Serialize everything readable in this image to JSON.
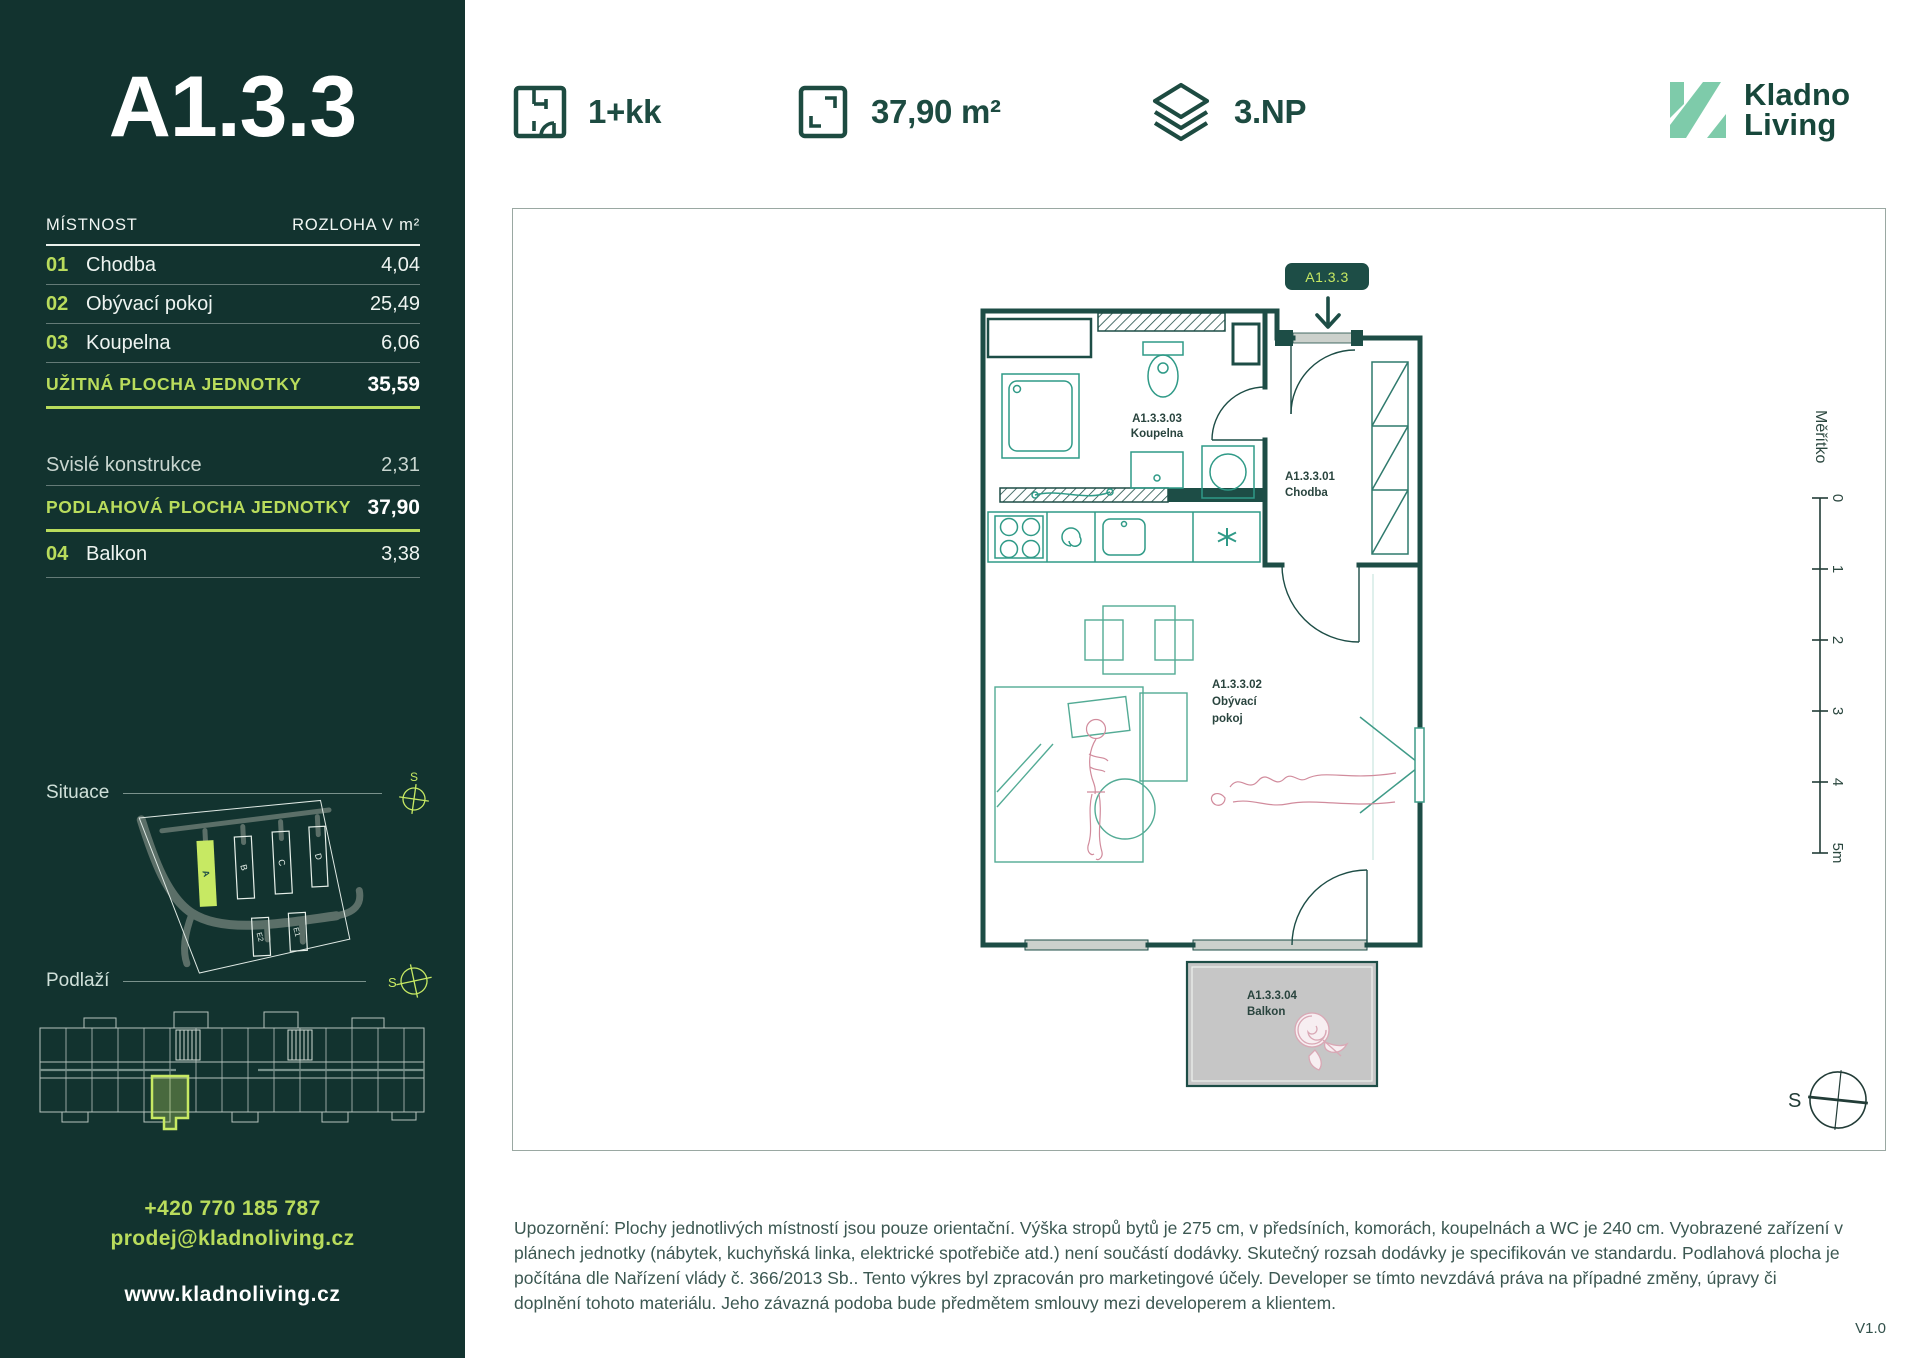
{
  "sidebar": {
    "unit_title": "A1.3.3",
    "table": {
      "header": {
        "room": "MÍSTNOST",
        "area": "ROZLOHA V m²"
      },
      "rows": [
        {
          "num": "01",
          "name": "Chodba",
          "value": "4,04"
        },
        {
          "num": "02",
          "name": "Obývací pokoj",
          "value": "25,49"
        },
        {
          "num": "03",
          "name": "Koupelna",
          "value": "6,06"
        }
      ],
      "usable_area": {
        "label": "UŽITNÁ PLOCHA JEDNOTKY",
        "value": "35,59"
      },
      "vertical_structures": {
        "label": "Svislé konstrukce",
        "value": "2,31"
      },
      "floor_area": {
        "label": "PODLAHOVÁ PLOCHA JEDNOTKY",
        "value": "37,90"
      },
      "balcony_row": {
        "num": "04",
        "name": "Balkon",
        "value": "3,38"
      }
    },
    "situace": {
      "label": "Situace",
      "compass_letter": "S",
      "buildings": [
        "A",
        "B",
        "C",
        "D",
        "E2",
        "E1"
      ],
      "highlighted_building": "A"
    },
    "podlazi": {
      "label": "Podlaží",
      "compass_letter": "S"
    },
    "contact": {
      "phone": "+420 770 185 787",
      "email": "prodej@kladnoliving.cz",
      "web": "www.kladnoliving.cz"
    }
  },
  "header": {
    "specs": [
      {
        "icon": "floorplan-icon",
        "label": "1+kk"
      },
      {
        "icon": "area-icon",
        "label": "37,90 m²"
      },
      {
        "icon": "floor-icon",
        "label": "3.NP"
      }
    ],
    "logo": {
      "line1": "Kladno",
      "line2": "Living"
    }
  },
  "plan": {
    "unit_badge": "A1.3.3",
    "room_labels": {
      "koupelna": {
        "code": "A1.3.3.03",
        "name": "Koupelna"
      },
      "chodba": {
        "code": "A1.3.3.01",
        "name": "Chodba"
      },
      "obyvaci": {
        "code": "A1.3.3.02",
        "name1": "Obývací",
        "name2": "pokoj"
      },
      "balkon": {
        "code": "A1.3.3.04",
        "name": "Balkon"
      }
    },
    "scale": {
      "label": "Měřítko",
      "ticks": [
        "0",
        "1",
        "2",
        "3",
        "4",
        "5m"
      ]
    },
    "compass_letter": "S"
  },
  "footer": {
    "disclaimer": "Upozornění: Plochy jednotlivých místností jsou pouze orientační. Výška stropů bytů je 275 cm, v předsíních, komorách, koupelnách a WC je 240 cm. Vyobrazené zařízení v plánech jednotky (nábytek, kuchyňská linka, elektrické spotřebiče atd.) není součástí dodávky. Skutečný rozsah dodávky je specifikován ve standardu. Podlahová plocha je počítána dle Nařízení vlády č. 366/2013 Sb.. Tento výkres byl zpracován pro marketingové účely. Developer se tímto nevzdává práva na případné změny, úpravy či doplnění tohoto materiálu. Jeho závazná podoba bude předmětem smlouvy mezi developerem a klientem.",
    "version": "V1.0"
  },
  "colors": {
    "sidebar_bg": "#12332f",
    "accent_lime": "#b9dc5c",
    "accent_lime_fill": "#c7e963",
    "dark_green": "#1d4b41",
    "wall_green": "#1d4d46",
    "logo_mint": "#7ecbaa",
    "fixture_teal": "#2f9a87",
    "furniture_green": "#53ab95",
    "sketch_pink": "#d18b9c",
    "balcony_gray": "#c6c6c6"
  }
}
